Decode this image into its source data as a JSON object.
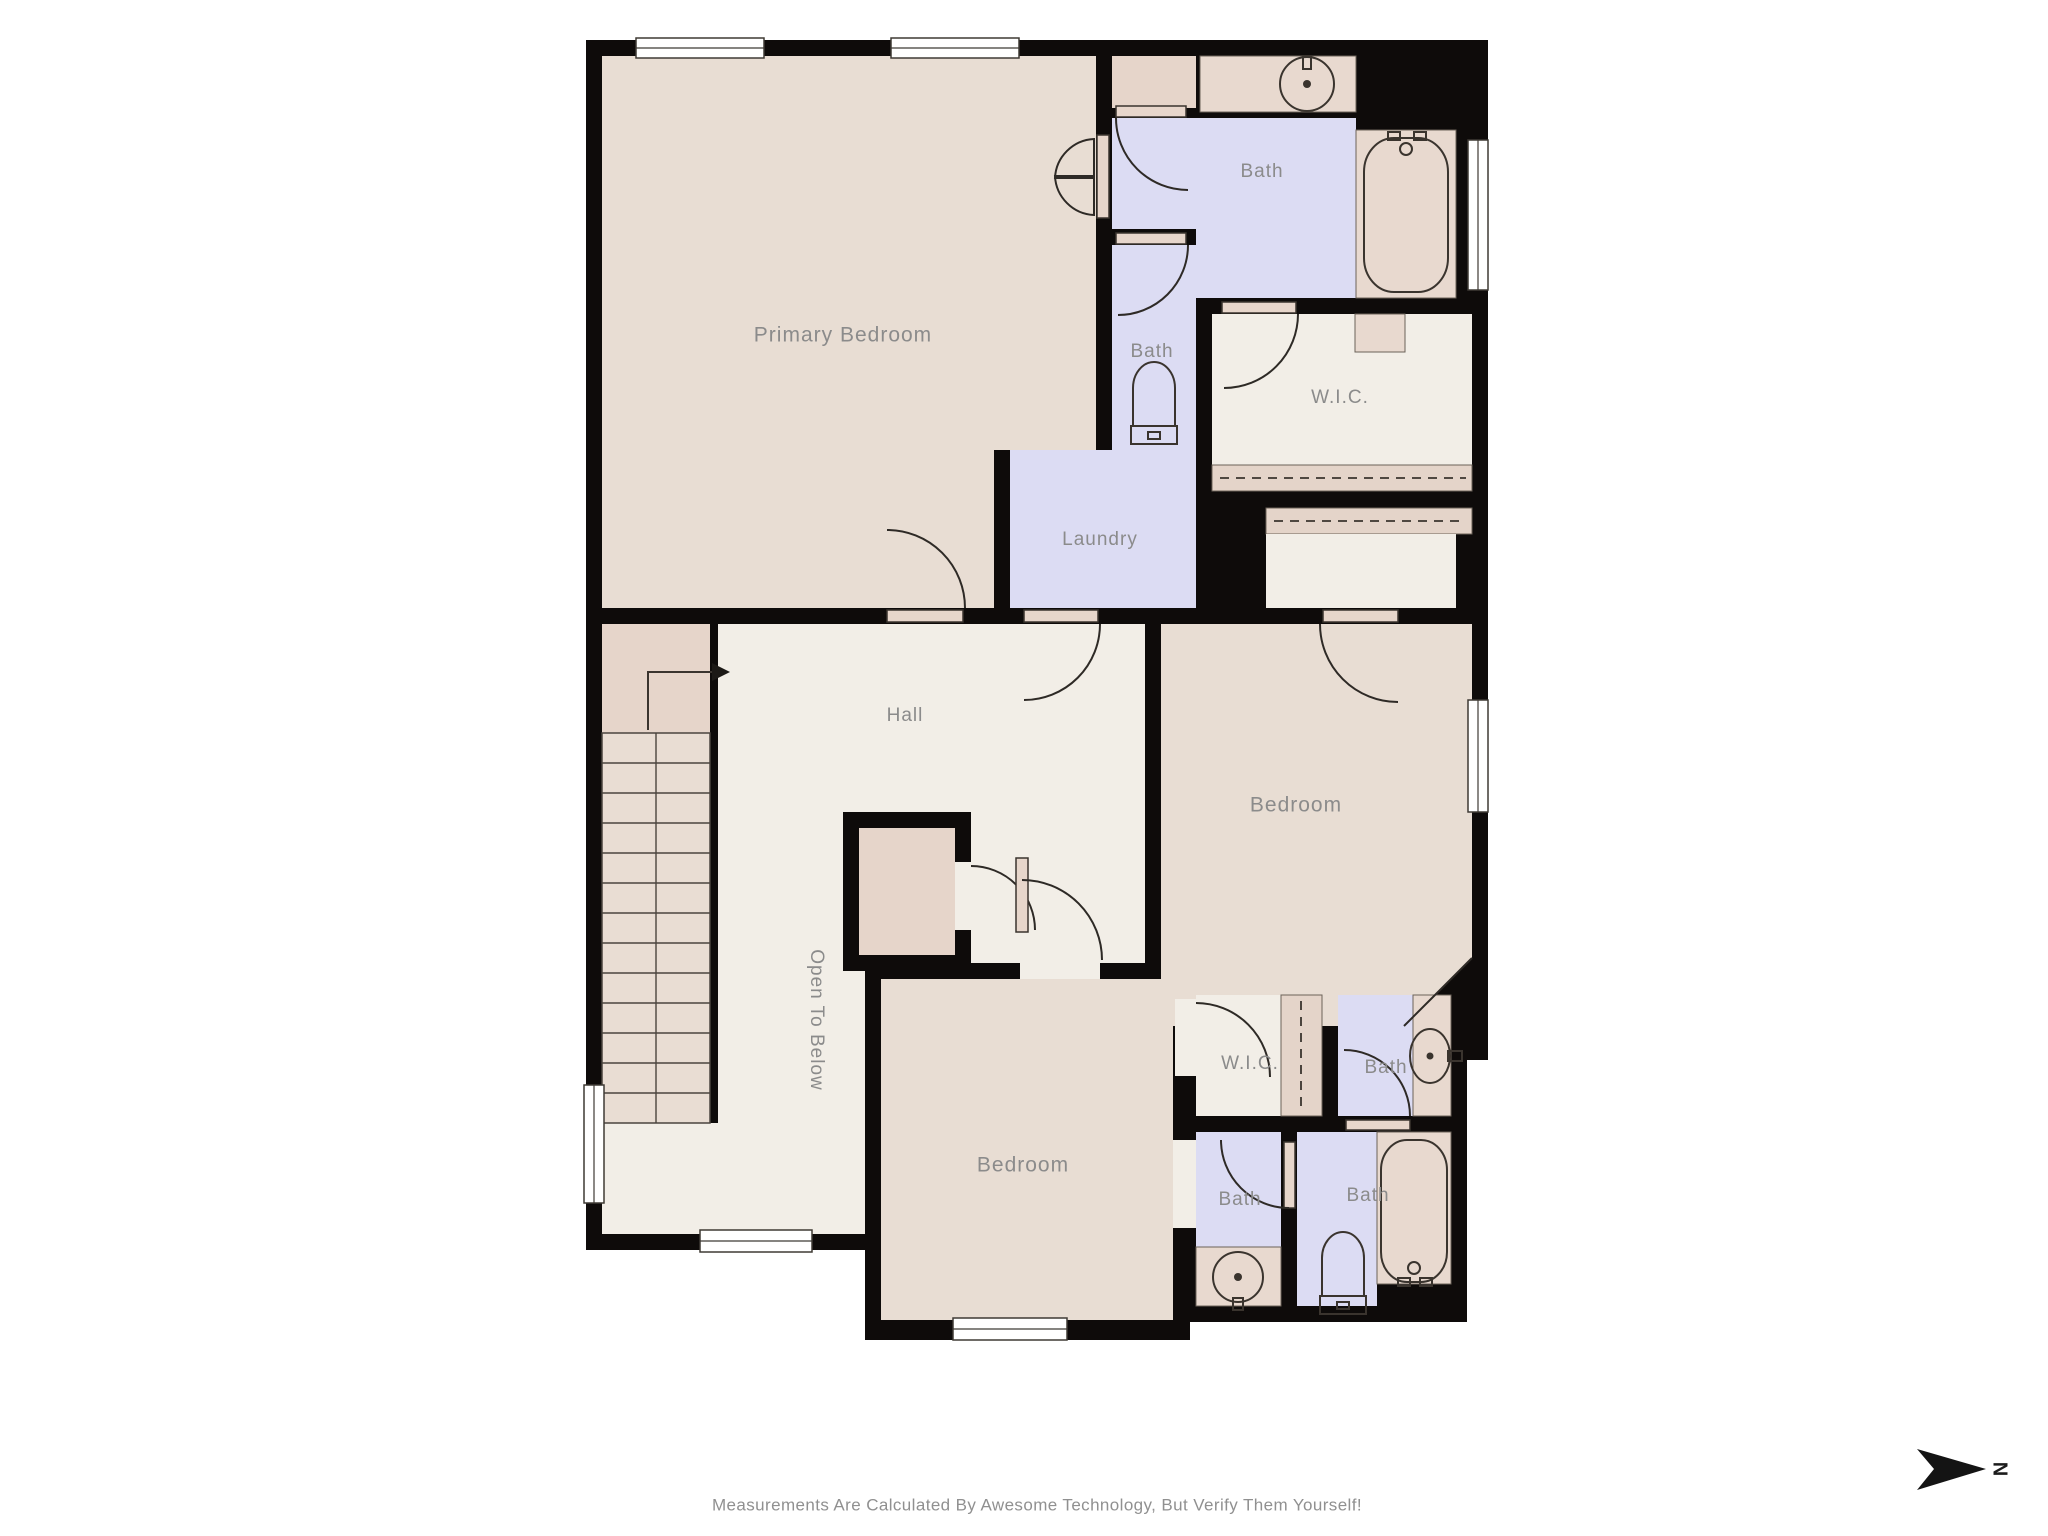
{
  "rooms": {
    "primary_bedroom": "Primary Bedroom",
    "bath_primary": "Bath",
    "bath_upper_small": "Bath",
    "wic_upper": "W.I.C.",
    "laundry": "Laundry",
    "hall": "Hall",
    "bedroom_right": "Bedroom",
    "open_to_below": "Open To Below",
    "bedroom_bottom": "Bedroom",
    "wic_lower": "W.I.C.",
    "bath_vanity": "Bath",
    "bath_small_lower": "Bath",
    "bath_tub_lower": "Bath"
  },
  "footer": {
    "disclaimer": "Measurements Are Calculated By Awesome Technology, But Verify Them Yourself!"
  },
  "compass": {
    "north_label": "N"
  },
  "colors": {
    "wall": "#0e0b0a",
    "bedroom_floor": "#e8ddd3",
    "bath_floor": "#dcdcf3",
    "hall_floor": "#f2eee7",
    "accent_floor": "#e6d5ca",
    "label_gray": "#8b8b8b"
  },
  "icons": {
    "compass_arrow": "north-arrow-icon",
    "stairs_arrow": "stairs-direction-arrow-icon"
  }
}
